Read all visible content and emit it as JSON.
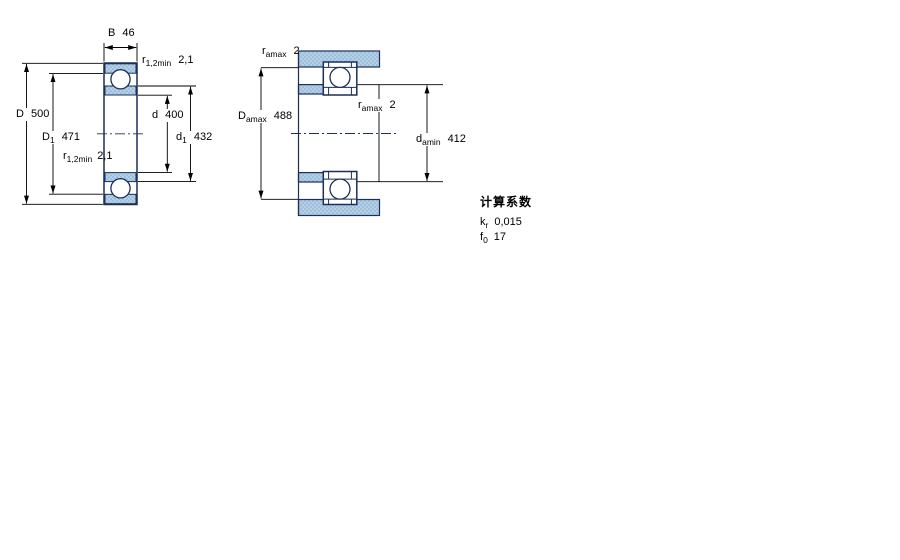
{
  "drawing": {
    "left_section": {
      "labels": {
        "width": {
          "sym": "B",
          "val": "46"
        },
        "outer_diameter": {
          "sym": "D",
          "val": "500"
        },
        "shoulder_outer": {
          "sym": "D",
          "sub": "1",
          "val": "471"
        },
        "bore": {
          "sym": "d",
          "val": "400"
        },
        "shoulder_inner": {
          "sym": "d",
          "sub": "1",
          "val": "432"
        },
        "fillet_top": {
          "sym": "r",
          "sub": "1,2min",
          "val": "2,1"
        },
        "fillet_bottom": {
          "sym": "r",
          "sub": "1,2min",
          "val": "2,1"
        }
      }
    },
    "right_section": {
      "labels": {
        "housing_fillet": {
          "sym": "r",
          "sub": "amax",
          "val": "2"
        },
        "housing_abutment": {
          "sym": "D",
          "sub": "amax",
          "val": "488"
        },
        "shaft_fillet": {
          "sym": "r",
          "sub": "amax",
          "val": "2"
        },
        "shaft_abutment": {
          "sym": "d",
          "sub": "amin",
          "val": "412"
        }
      }
    }
  },
  "calculation_factors": {
    "title": "计算系数",
    "rows": [
      {
        "sym": "k",
        "sub": "r",
        "val": "0,015"
      },
      {
        "sym": "f",
        "sub": "0",
        "val": "17"
      }
    ]
  },
  "colors": {
    "outline_navy": "#1c2f58",
    "section_fill": "#b3d0e7",
    "section_dot": "#86aacd",
    "dimension_line": "#000000"
  }
}
